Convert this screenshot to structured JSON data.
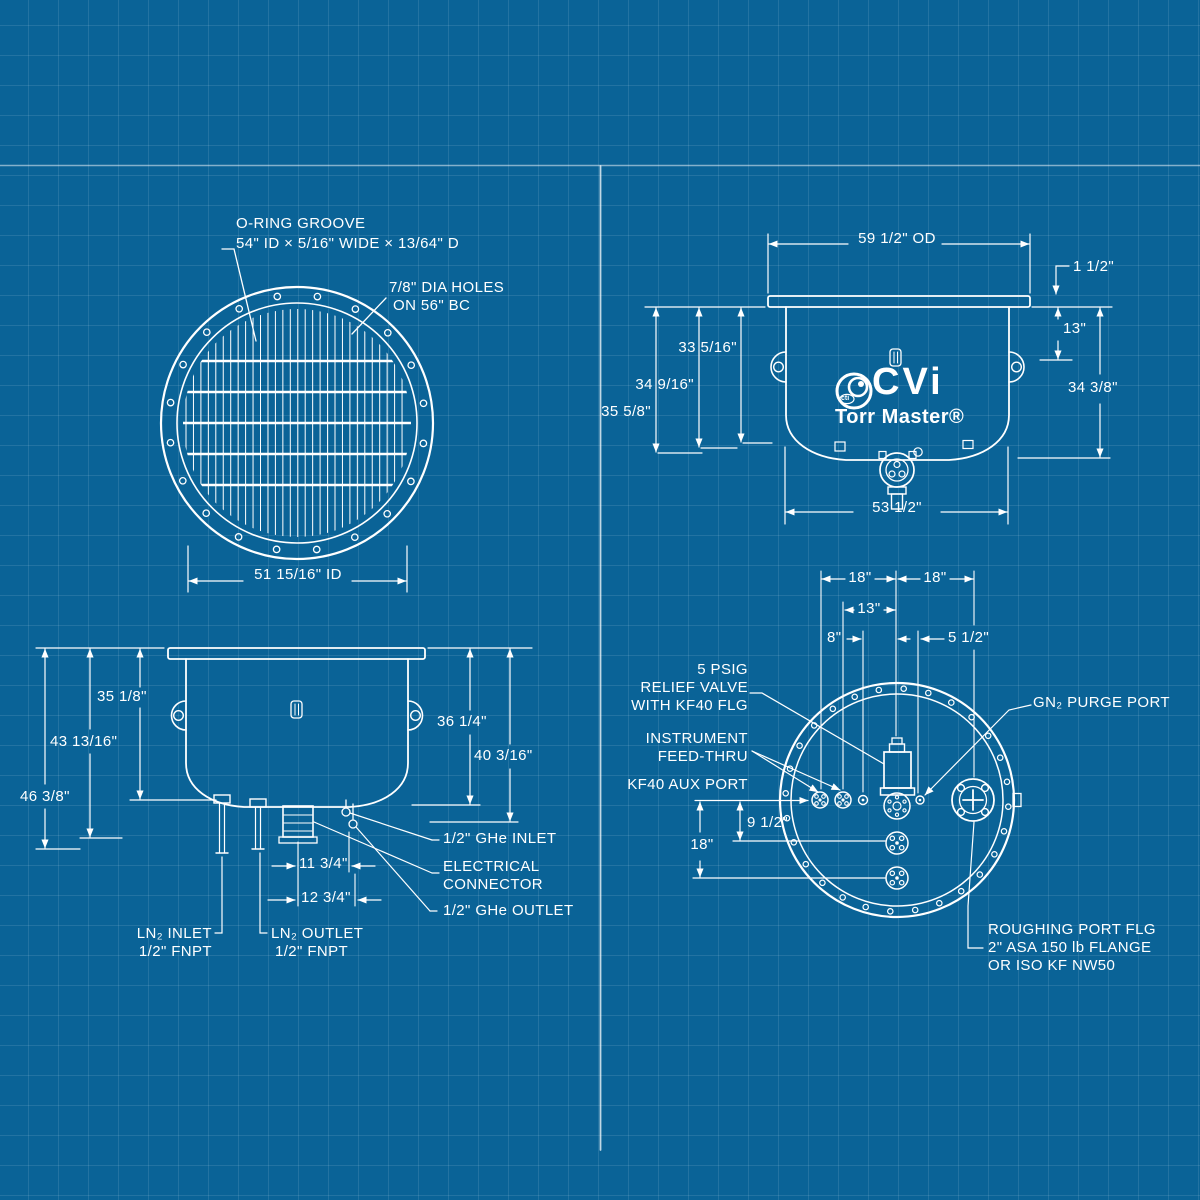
{
  "colors": {
    "background": "#0a6397",
    "grid_line": "rgba(255,255,255,0.10)",
    "line_color": "#ffffff"
  },
  "top_view": {
    "oring_label_line1": "O-RING GROOVE",
    "oring_label_line2": "54\" ID × 5/16\" WIDE × 13/64\" D",
    "bolt_holes_line1": "7/8\" DIA HOLES",
    "bolt_holes_line2": "ON 56\" BC",
    "inner_diameter_dim": "51 15/16\" ID"
  },
  "front_view": {
    "outer_diameter_dim": "59 1/2\" OD",
    "flange_lip_dim": "1 1/2\"",
    "flange_to_lug_dim": "13\"",
    "inner_depth_dim": "33 5/16\"",
    "mid_depth_dim": "34 9/16\"",
    "outer_depth_dim": "35 5/8\"",
    "right_height_dim": "34 3/8\"",
    "body_width_dim": "53 1/2\"",
    "logo_brand": "CVi",
    "logo_emblem": "cti",
    "logo_product": "Torr Master®"
  },
  "side_view": {
    "depth_dim_a": "35 1/8\"",
    "depth_dim_b": "43 13/16\"",
    "depth_dim_c": "46 3/8\"",
    "depth_dim_d": "36 1/4\"",
    "depth_dim_e": "40 3/16\"",
    "offset_dim_a": "11 3/4\"",
    "offset_dim_b": "12 3/4\"",
    "ghe_inlet_label": "1/2\" GHe INLET",
    "electrical_label_line1": "ELECTRICAL",
    "electrical_label_line2": "CONNECTOR",
    "ghe_outlet_label": "1/2\" GHe OUTLET",
    "ln2_inlet_label_line1": "LN₂ INLET",
    "ln2_inlet_label_line2": "1/2\" FNPT",
    "ln2_outlet_label_line1": "LN₂ OUTLET",
    "ln2_outlet_label_line2": "1/2\" FNPT"
  },
  "bottom_view": {
    "left_radius_dim": "18\"",
    "right_radius_dim": "18\"",
    "port_b_offset_dim": "13\"",
    "aux_port_offset_dim": "8\"",
    "purge_port_offset_dim": "5 1/2\"",
    "vertical_offset_dim": "9 1/2\"",
    "lower_port_offset_dim": "18\"",
    "relief_valve_label_line1": "5 PSIG",
    "relief_valve_label_line2": "RELIEF VALVE",
    "relief_valve_label_line3": "WITH KF40 FLG",
    "instrument_label_line1": "INSTRUMENT",
    "instrument_label_line2": "FEED-THRU",
    "aux_port_label": "KF40 AUX PORT",
    "gn2_purge_label": "GN₂ PURGE PORT",
    "roughing_label_line1": "ROUGHING PORT FLG",
    "roughing_label_line2": "2\" ASA 150 lb FLANGE",
    "roughing_label_line3": "OR ISO KF NW50"
  }
}
